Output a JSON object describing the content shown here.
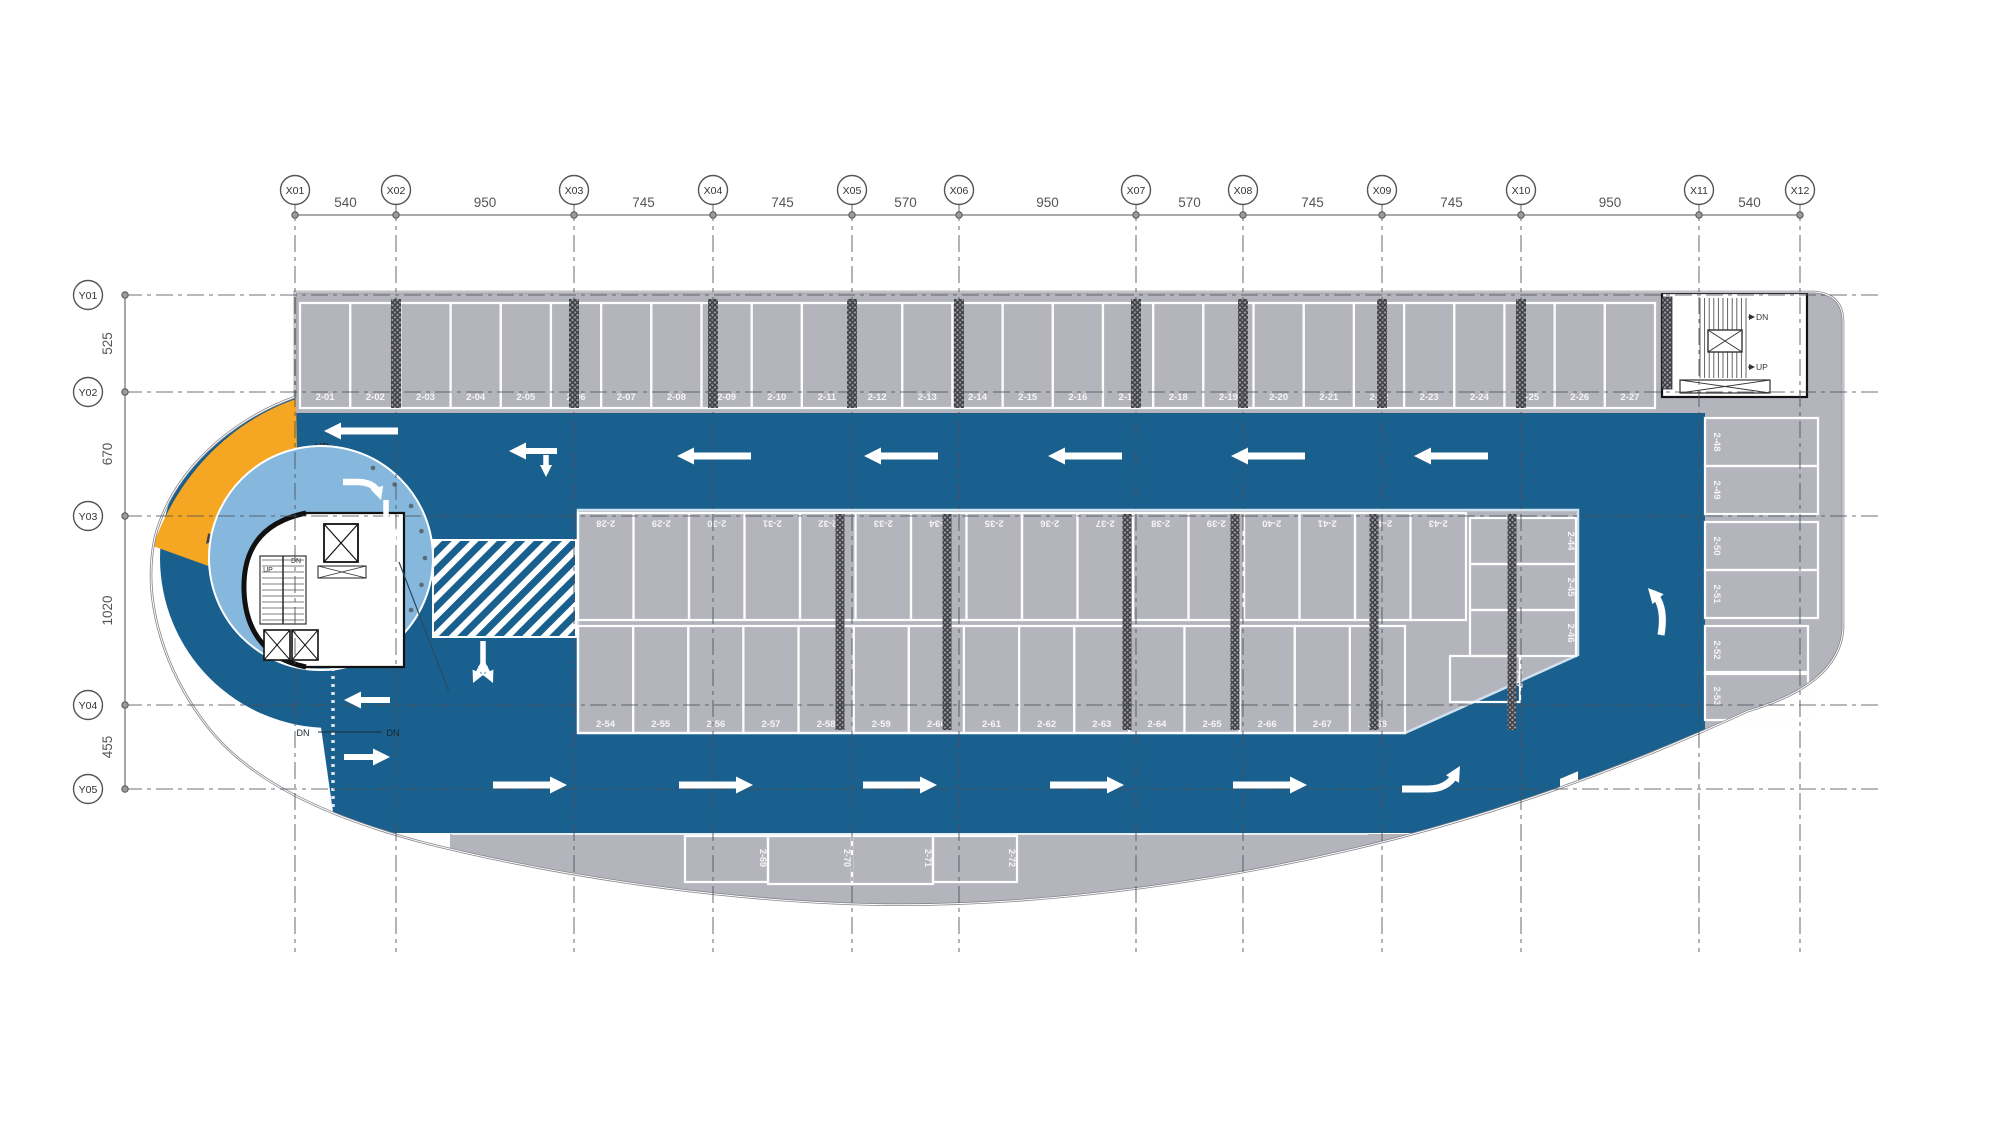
{
  "grid": {
    "x_labels": [
      "X01",
      "X02",
      "X03",
      "X04",
      "X05",
      "X06",
      "X07",
      "X08",
      "X09",
      "X10",
      "X11",
      "X12"
    ],
    "x_dims": [
      "540",
      "950",
      "745",
      "745",
      "570",
      "950",
      "570",
      "745",
      "745",
      "950",
      "540"
    ],
    "y_labels": [
      "Y01",
      "Y02",
      "Y03",
      "Y04",
      "Y05"
    ],
    "y_dims": [
      "525",
      "670",
      "1020",
      "455"
    ]
  },
  "stalls": {
    "top_row": [
      "2-01",
      "2-02",
      "2-03",
      "2-04",
      "2-05",
      "2-06",
      "2-07",
      "2-08",
      "2-09",
      "2-10",
      "2-11",
      "2-12",
      "2-13",
      "2-14",
      "2-15",
      "2-16",
      "2-17",
      "2-18",
      "2-19",
      "2-20",
      "2-21",
      "2-22",
      "2-23",
      "2-24",
      "2-25",
      "2-26",
      "2-27"
    ],
    "island_top": [
      "2-28",
      "2-29",
      "2-30",
      "2-31",
      "2-32",
      "2-33",
      "2-34",
      "2-35",
      "2-36",
      "2-37",
      "2-38",
      "2-39",
      "2-40",
      "2-41",
      "2-42",
      "2-43"
    ],
    "island_right_end": [
      "2-44",
      "2-45",
      "2-46",
      "2-47"
    ],
    "right_column": [
      "2-48",
      "2-49",
      "2-50",
      "2-51",
      "2-52",
      "2-53"
    ],
    "island_bottom": [
      "2-54",
      "2-55",
      "2-56",
      "2-57",
      "2-58",
      "2-59",
      "2-60",
      "2-61",
      "2-62",
      "2-63",
      "2-64",
      "2-65",
      "2-66",
      "2-67",
      "2-68"
    ],
    "bottom_arc": [
      "2-69",
      "2-70",
      "2-71",
      "2-72"
    ]
  },
  "annotations": {
    "ramp_up": "UP",
    "core_up": "UP",
    "core_dn": "DN",
    "stair_dn": "DN",
    "stair_up": "UP",
    "ramp_dn_left": "DN",
    "ramp_dn_right": "DN"
  },
  "colors": {
    "aisle_blue": "#1A608F",
    "ramp_orange": "#F5A623",
    "inner_circle_blue": "#86B8DD",
    "floor_gray": "#B4B4BD",
    "stall_line_white": "#FDFDFD",
    "outline_gray": "#85858D",
    "grid_line": "#4A4F55",
    "dim_text": "#555555"
  }
}
